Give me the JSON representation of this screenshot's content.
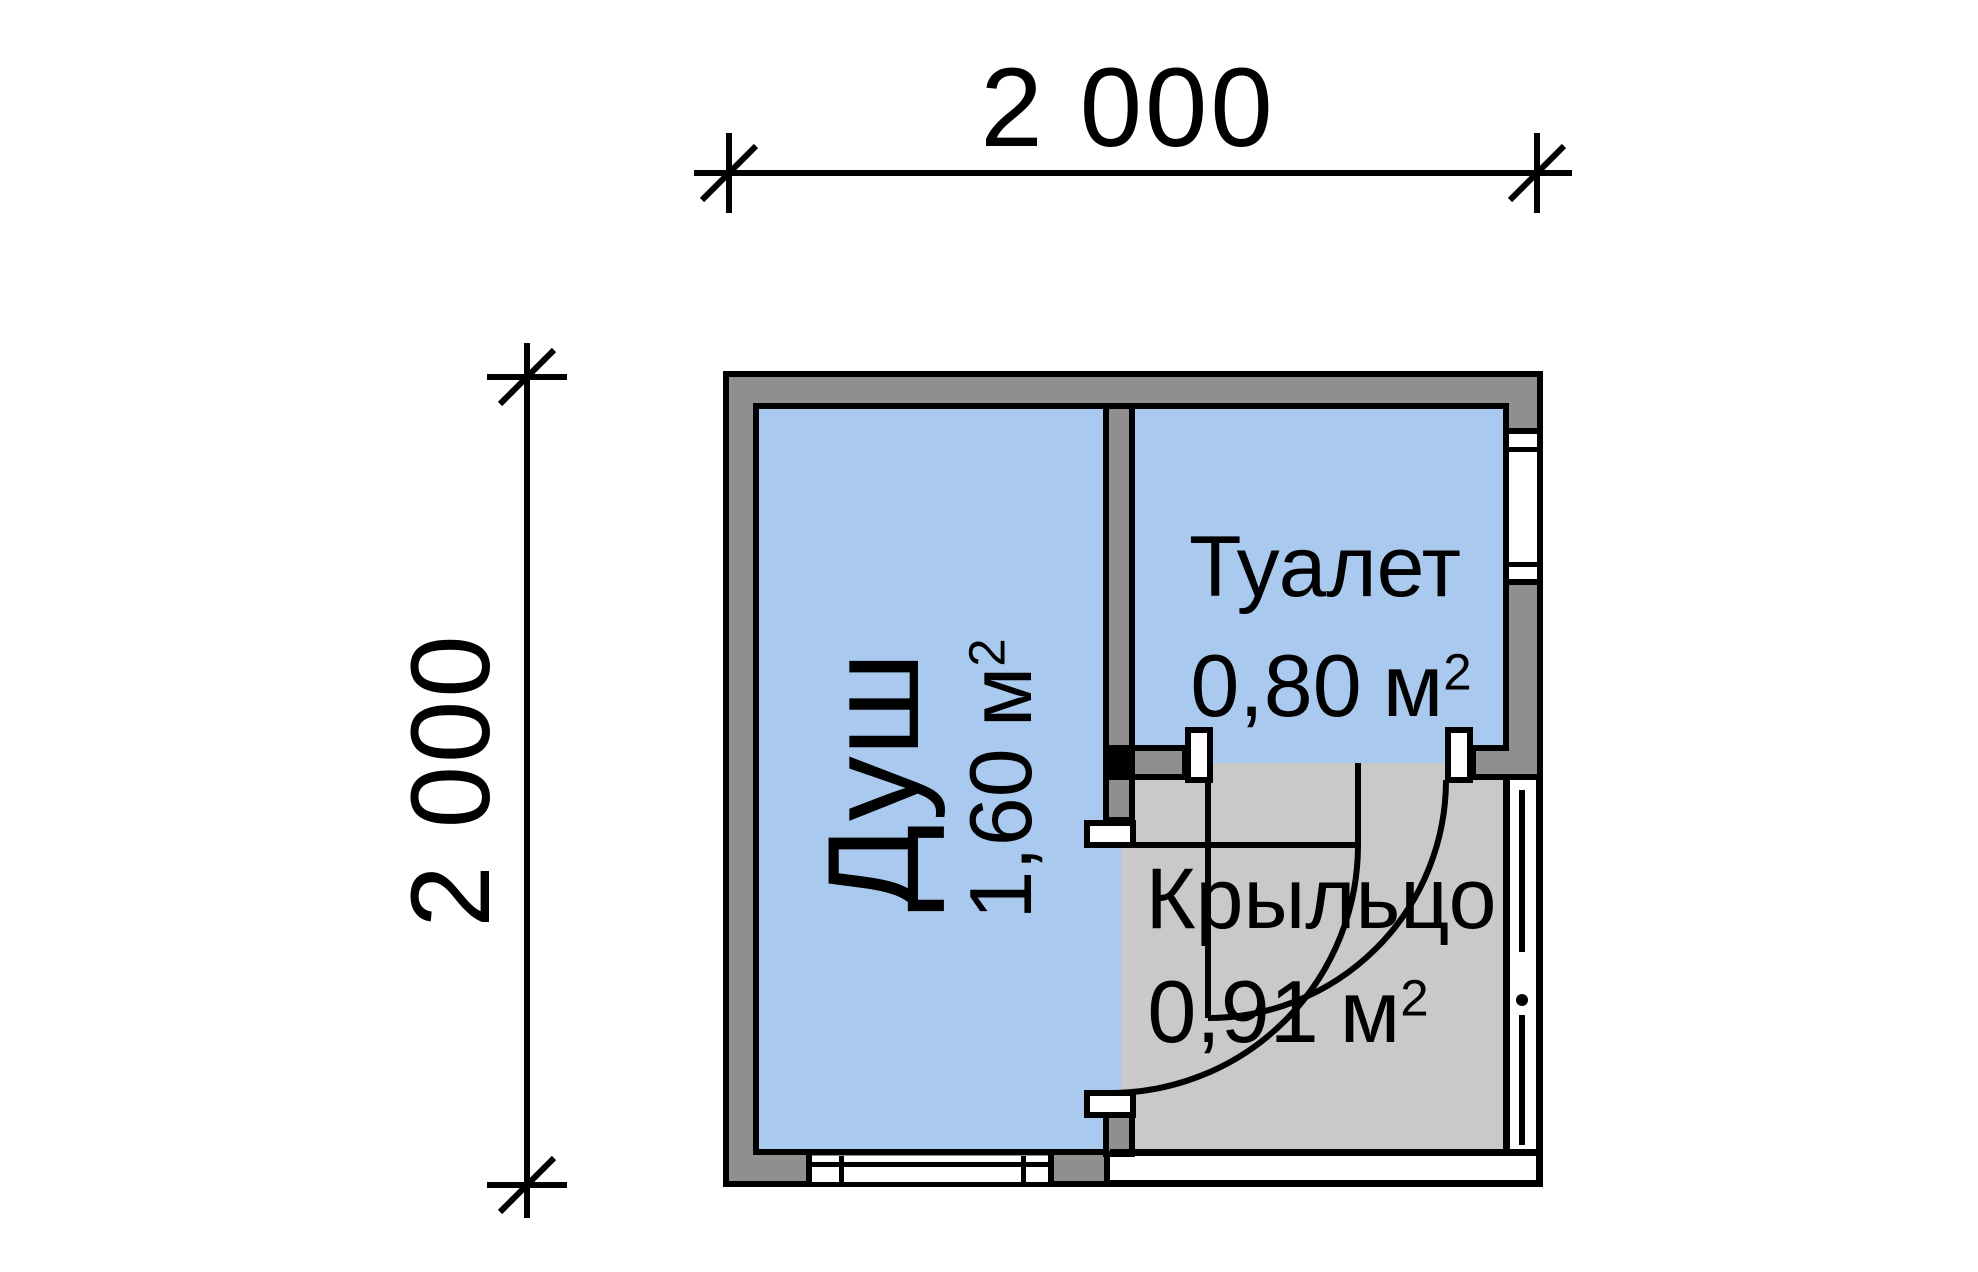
{
  "dimensions": {
    "top": "2 000",
    "left": "2 000"
  },
  "rooms": {
    "shower": {
      "name": "Душ",
      "area_value": "1,60",
      "area_unit": "м",
      "area_sup": "2"
    },
    "toilet": {
      "name": "Туалет",
      "area_value": "0,80",
      "area_unit": "м",
      "area_sup": "2"
    },
    "porch": {
      "name": "Крыльцо",
      "area_value": "0,91",
      "area_unit": "м",
      "area_sup": "2"
    }
  },
  "colors": {
    "room_fill": "#aac9ee",
    "porch_fill": "#c9c9c9",
    "wall_fill": "#8f8f8f",
    "line": "#000000",
    "background": "#ffffff"
  }
}
